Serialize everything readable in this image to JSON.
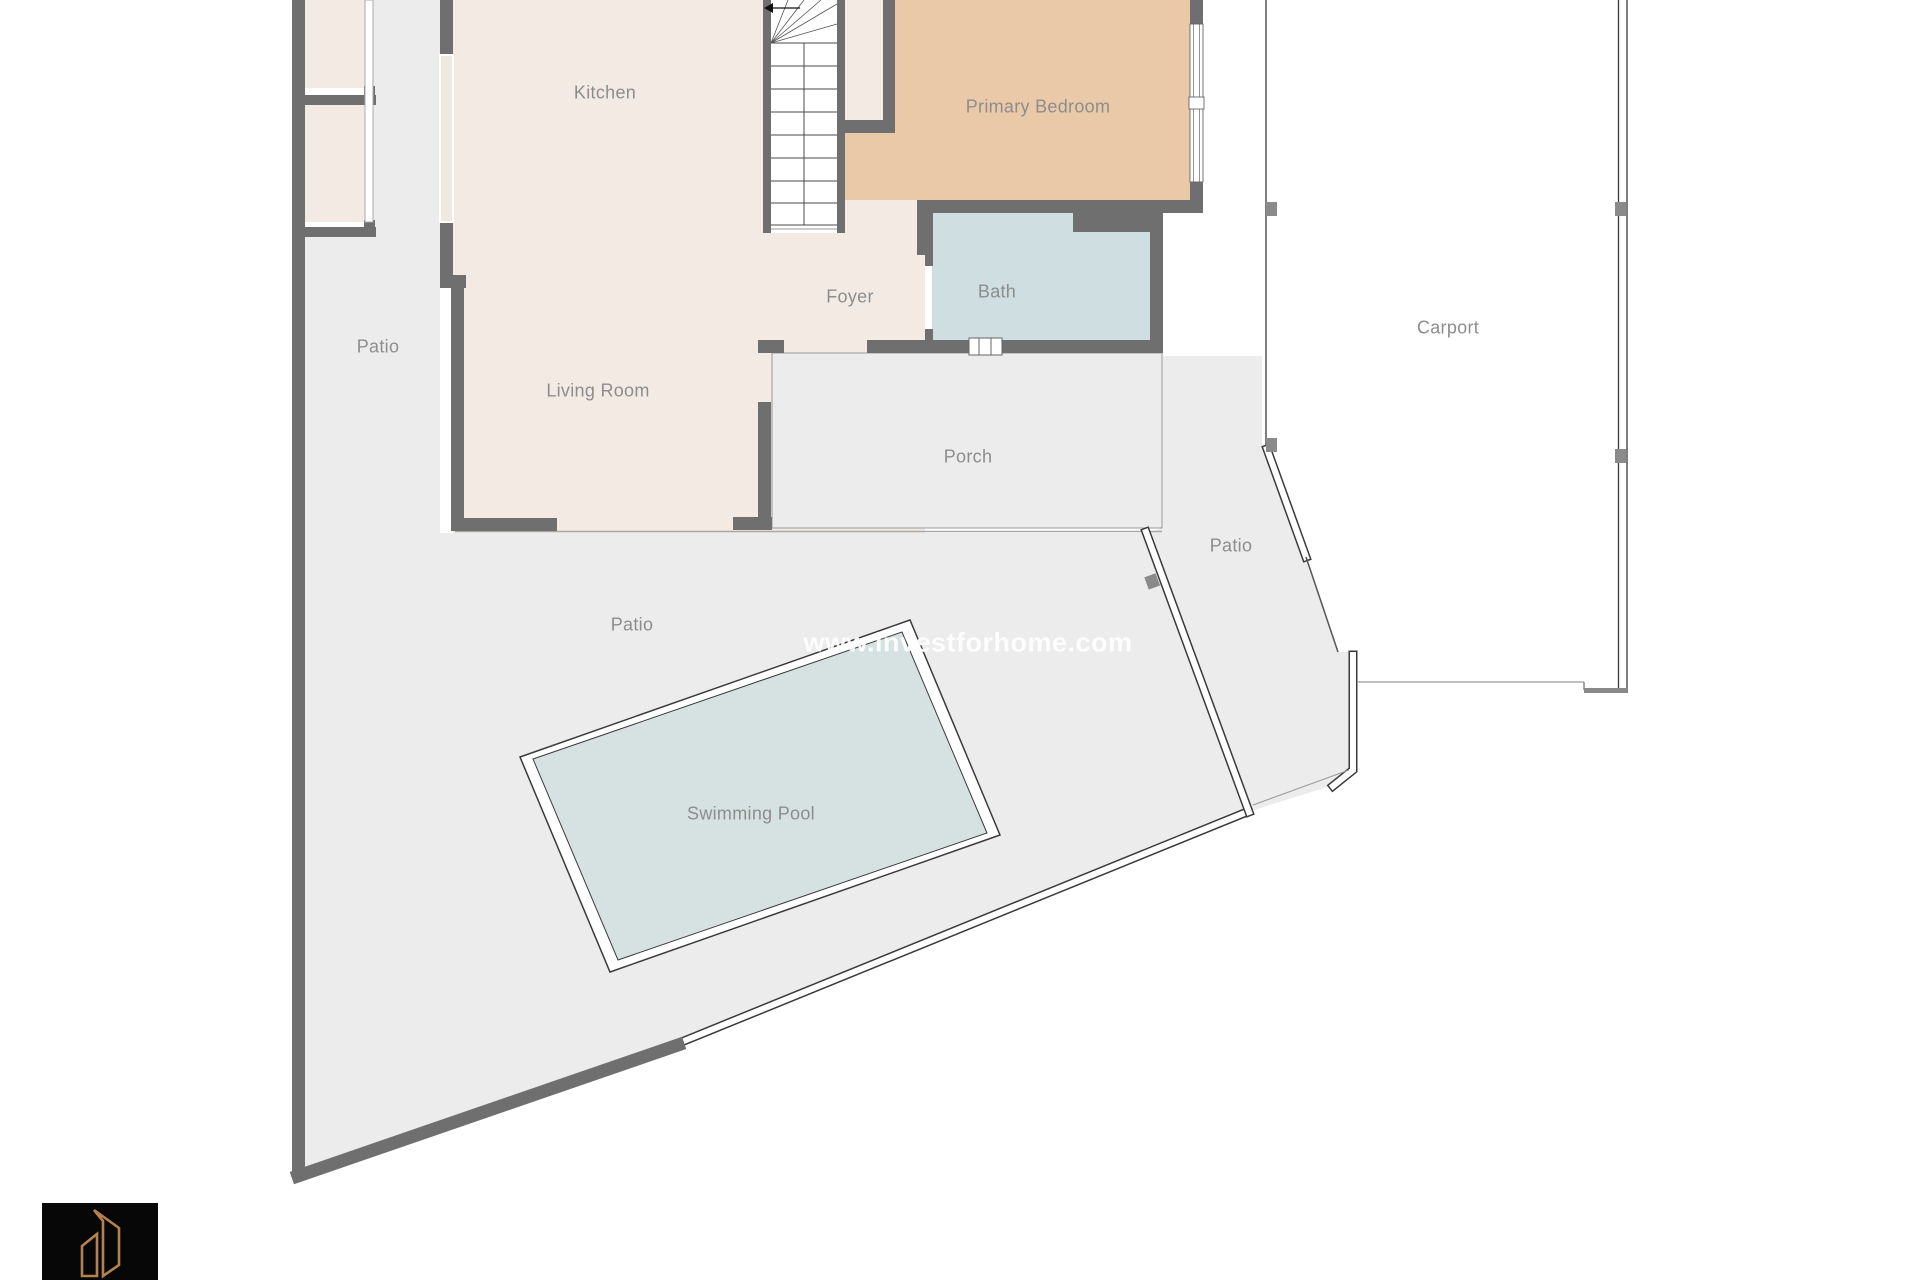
{
  "rooms": {
    "kitchen": {
      "label": "Kitchen"
    },
    "primary_bedroom": {
      "label": "Primary Bedroom"
    },
    "foyer": {
      "label": "Foyer"
    },
    "bath": {
      "label": "Bath"
    },
    "patio_left": {
      "label": "Patio"
    },
    "living_room": {
      "label": "Living Room"
    },
    "porch": {
      "label": "Porch"
    },
    "patio_right": {
      "label": "Patio"
    },
    "patio_center": {
      "label": "Patio"
    },
    "swimming_pool": {
      "label": "Swimming Pool"
    },
    "carport": {
      "label": "Carport"
    }
  },
  "watermark": {
    "text": "www.investforhome.com"
  },
  "colors": {
    "floor_cream": "#f3eae4",
    "bedroom_tan": "#eac9a8",
    "bath_blue": "#cfdfe1",
    "water_blue": "#d5e2e1",
    "ground_gray": "#ececec",
    "wall_gray": "#6f6f6f",
    "outline_dark": "#3a3a3a",
    "thin_gray": "#9a9a9a",
    "label_gray": "#8d8d8d",
    "watermark_white": "#ffffff",
    "logo_copper": "#b5824f"
  }
}
